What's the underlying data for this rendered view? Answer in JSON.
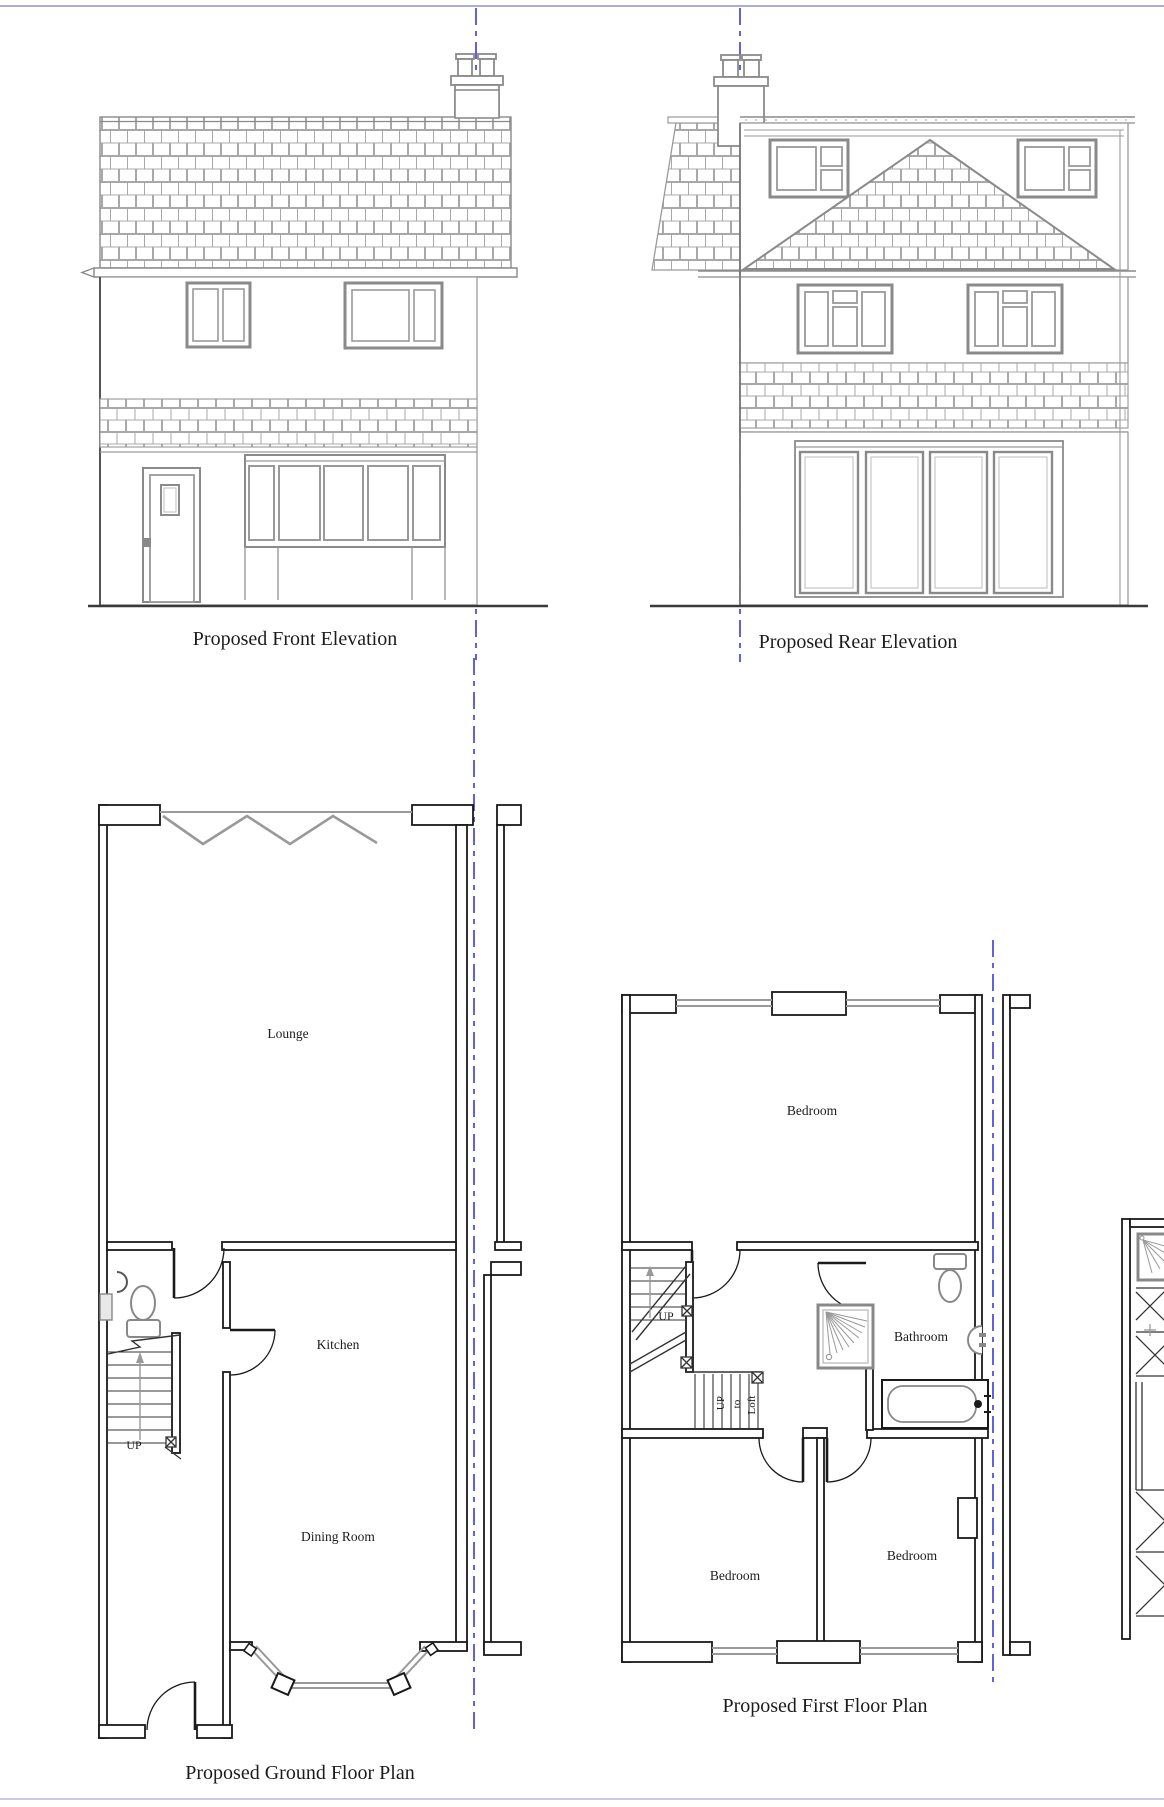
{
  "colors": {
    "centerline_blue": "#3b3bd6",
    "sheet_border": "#8f8fce",
    "elevation_line_gray": "#8a8a8a",
    "plan_wall_dark": "#1a1a1a"
  },
  "front_elevation": {
    "title": "Proposed Front Elevation"
  },
  "rear_elevation": {
    "title": "Proposed Rear Elevation"
  },
  "ground_floor_plan": {
    "title": "Proposed Ground Floor Plan",
    "rooms": {
      "lounge": "Lounge",
      "kitchen": "Kitchen",
      "dining_room": "Dining Room"
    },
    "stair_label": "UP"
  },
  "first_floor_plan": {
    "title": "Proposed First Floor Plan",
    "rooms": {
      "bedroom_rear": "Bedroom",
      "bathroom": "Bathroom",
      "bedroom_front_left": "Bedroom",
      "bedroom_front_right": "Bedroom"
    },
    "stair_label": "UP",
    "loft_stair_label": {
      "up": "UP",
      "to": "to",
      "loft": "Loft"
    }
  }
}
